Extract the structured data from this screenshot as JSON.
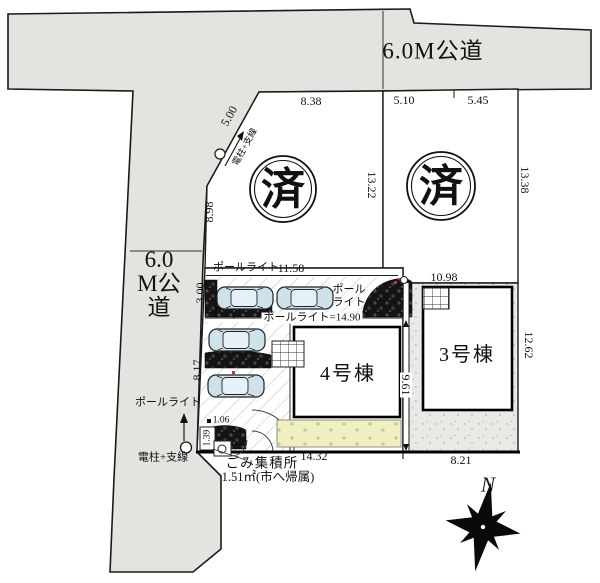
{
  "roads": {
    "top_label": "6.0M公道",
    "left_label": "6.0M公道"
  },
  "stamps": {
    "sold": "済"
  },
  "buildings": {
    "b4": "4号棟",
    "b3": "3号棟"
  },
  "dimensions": {
    "top_1": "8.38",
    "top_2": "5.10",
    "top_3": "5.45",
    "upper_mid_right": "13.22",
    "upper_right": "13.38",
    "diag": "5.00",
    "left_upper": "8.98",
    "left_mid": "3.00",
    "left_lower": "8.17",
    "north_strip": "11.58",
    "mid_strip": "ポールライト=14.90",
    "lot3_top": "10.98",
    "lot3_right": "12.62",
    "between_lots": "9.61",
    "bottom_lot4": "14.32",
    "bottom_lot3": "8.21",
    "corner_w": "1.06",
    "corner_h": "1.39"
  },
  "labels": {
    "pole_light_north": "ポールライト",
    "pole_light_east_1": "ポール",
    "pole_light_east_2": "ライト",
    "pole_light_sw": "ポールライト",
    "utility_pole_top": "電柱+支線",
    "utility_pole_sw": "電柱+支線",
    "garbage_1": "ごみ集積所",
    "garbage_2": "1.51㎡(市へ帰属)",
    "north": "N"
  },
  "colors": {
    "road": "#e3e3e0",
    "ground": "#e9e9e5",
    "garden": "#f0efc2",
    "car": "#cfe2ec",
    "planter": "#141414"
  }
}
